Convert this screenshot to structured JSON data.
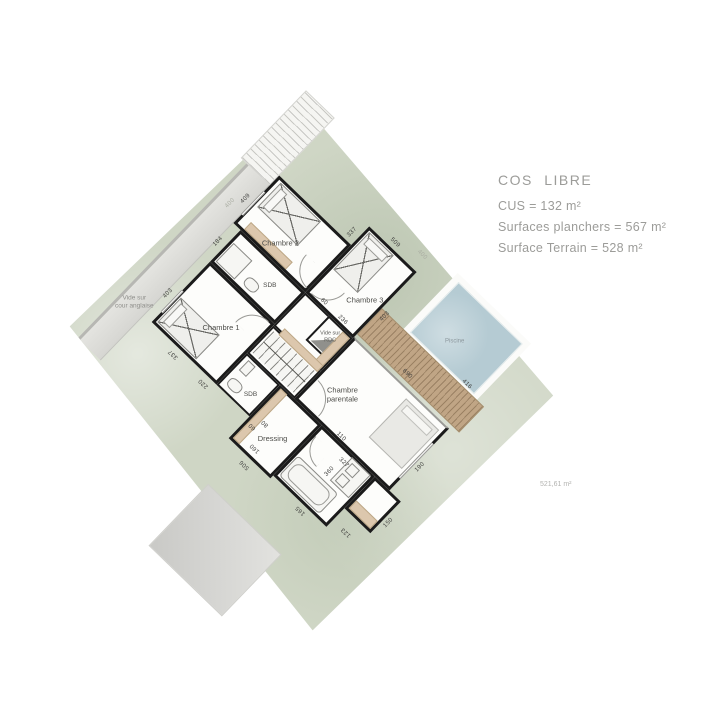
{
  "annotations": {
    "title": "COS LIBRE",
    "line1": "CUS = 132 m²",
    "line2": "Surfaces planchers = 567 m²",
    "line3": "Surface Terrain = 528 m²",
    "parcel_area": "521,61 m²"
  },
  "plan": {
    "labels": {
      "chambre1": "Chambre 1",
      "chambre2": "Chambre 2",
      "chambre3": "Chambre 3",
      "sdb1": "SDB",
      "sdb2": "SDB",
      "parentale_l1": "Chambre",
      "parentale_l2": "parentale",
      "dressing": "Dressing",
      "vide_rdc_l1": "Vide sur",
      "vide_rdc_l2": "RDC",
      "cour_l1": "Vide sur",
      "cour_l2": "cour anglaise",
      "piscine": "Piscine"
    },
    "dims": {
      "d403a": "403",
      "d184": "184",
      "d409": "409",
      "d337a": "337",
      "d337b": "337",
      "d509": "509",
      "d403b": "403",
      "d236": "236",
      "d690": "690",
      "d416": "416",
      "d190": "190",
      "d110": "110",
      "d220": "220",
      "d160": "160",
      "d506": "506",
      "d360": "360",
      "d165": "165",
      "d123": "123",
      "d327": "327",
      "d150": "150",
      "d60a": "60",
      "d60b": "60",
      "d80": "80",
      "d400a": "400",
      "d400b": "400"
    }
  },
  "colors": {
    "terrain": "#cfd6c5",
    "pool": "#b5cbd3",
    "deck": "#c0a585",
    "wall": "#1b1b1b",
    "closet_tan": "#dcc7ad",
    "annotation_grey": "#9c9c99"
  }
}
